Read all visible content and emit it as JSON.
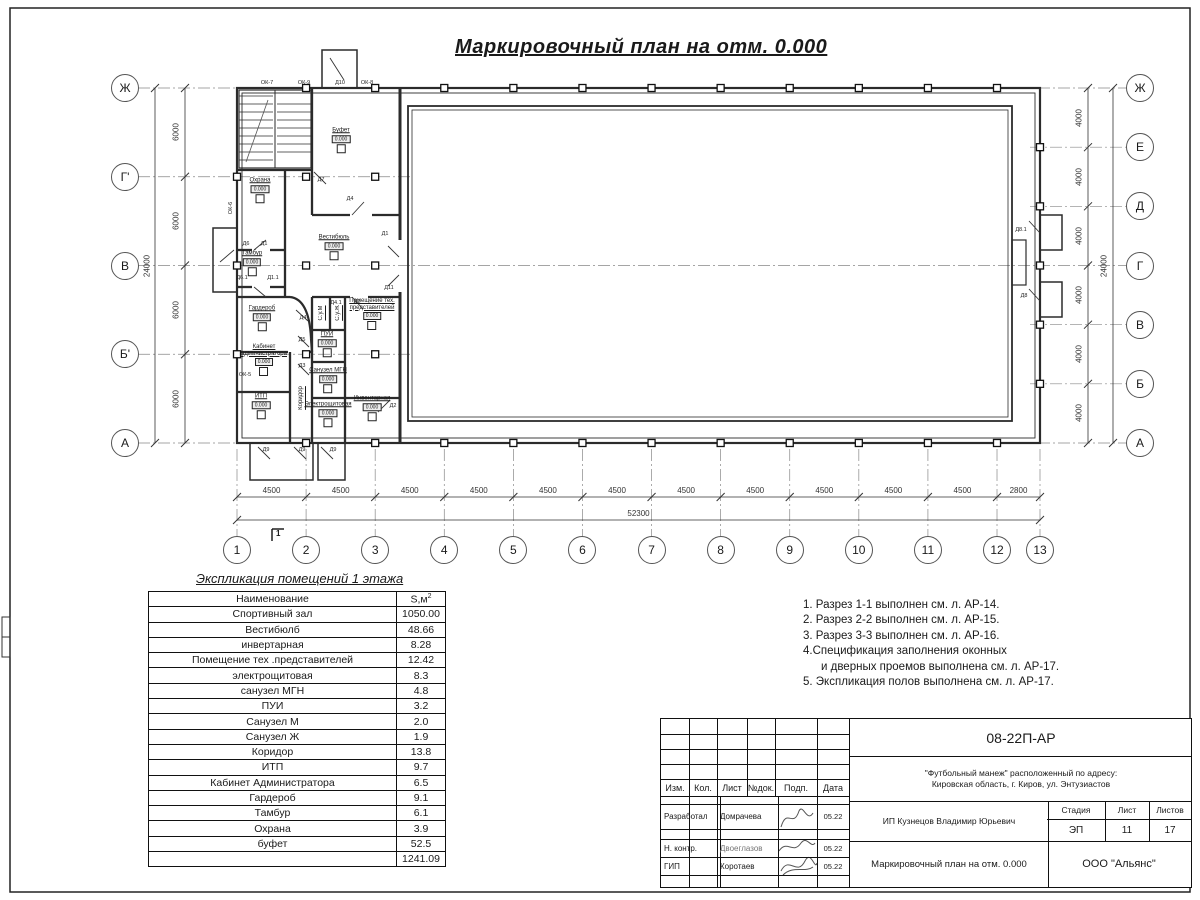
{
  "sheet": {
    "title": "Маркировочный план на отм. 0.000"
  },
  "plan": {
    "axes_left": [
      "Ж",
      "Г'",
      "В",
      "Б'",
      "А"
    ],
    "axes_right": [
      "Ж",
      "Е",
      "Д",
      "Г",
      "В",
      "Б",
      "А"
    ],
    "axes_bottom": [
      "1",
      "2",
      "3",
      "4",
      "5",
      "6",
      "7",
      "8",
      "9",
      "10",
      "11",
      "12",
      "13"
    ],
    "dims_left": [
      "6000",
      "6000",
      "6000",
      "6000"
    ],
    "dims_left_total": "24000",
    "dims_right": [
      "4000",
      "4000",
      "4000",
      "4000",
      "4000",
      "4000"
    ],
    "dims_right_total": "24000",
    "dims_bottom": [
      "4500",
      "4500",
      "4500",
      "4500",
      "4500",
      "4500",
      "4500",
      "4500",
      "4500",
      "4500",
      "4500",
      "2800"
    ],
    "dims_bottom_total": "52300",
    "level_mark": "0.000",
    "section_mark": "1",
    "rooms": [
      {
        "name": "Буфет",
        "x": 341,
        "y": 140,
        "level": true
      },
      {
        "name": "Охрана",
        "x": 260,
        "y": 190,
        "level": true
      },
      {
        "name": "Тамбур",
        "x": 252,
        "y": 263,
        "level": true
      },
      {
        "name": "Вестибюль",
        "x": 334,
        "y": 247,
        "level": true
      },
      {
        "name": "Гардероб",
        "x": 262,
        "y": 318,
        "level": true
      },
      {
        "name": "Кабинет\nадминистратора",
        "x": 264,
        "y": 360,
        "level": true
      },
      {
        "name": "ИТП",
        "x": 261,
        "y": 406,
        "level": true
      },
      {
        "name": "Коридор",
        "x": 301,
        "y": 398,
        "vertical": true
      },
      {
        "name": "Электрощитовая",
        "x": 328,
        "y": 414,
        "level": true
      },
      {
        "name": "Инвентарная",
        "x": 372,
        "y": 408,
        "level": true
      },
      {
        "name": "Помещение тех.\nпредставителей",
        "x": 372,
        "y": 314,
        "level": true
      },
      {
        "name": "ПУИ",
        "x": 327,
        "y": 344,
        "level": true
      },
      {
        "name": "Санузел МГН",
        "x": 328,
        "y": 380,
        "level": true
      },
      {
        "name": "С.у.М",
        "x": 321,
        "y": 313,
        "vertical": true
      },
      {
        "name": "С.у.Ж",
        "x": 338,
        "y": 313,
        "vertical": true
      }
    ],
    "openings": [
      {
        "label": "ОК-7",
        "x": 267,
        "y": 83
      },
      {
        "label": "ОК-9",
        "x": 304,
        "y": 83
      },
      {
        "label": "Д10",
        "x": 340,
        "y": 83
      },
      {
        "label": "ОК-8",
        "x": 367,
        "y": 83
      },
      {
        "label": "ОК-6",
        "x": 231,
        "y": 208,
        "vertical": true
      },
      {
        "label": "ОК-5",
        "x": 245,
        "y": 375
      },
      {
        "label": "Д7",
        "x": 321,
        "y": 180
      },
      {
        "label": "Д4",
        "x": 350,
        "y": 199
      },
      {
        "label": "Д6",
        "x": 246,
        "y": 244
      },
      {
        "label": "Д1",
        "x": 264,
        "y": 244
      },
      {
        "label": "Д6.1",
        "x": 242,
        "y": 278
      },
      {
        "label": "Д1.1",
        "x": 273,
        "y": 278
      },
      {
        "label": "Д1",
        "x": 385,
        "y": 234
      },
      {
        "label": "Д11",
        "x": 389,
        "y": 288
      },
      {
        "label": "Д2",
        "x": 357,
        "y": 302
      },
      {
        "label": "Д4.1",
        "x": 336,
        "y": 303
      },
      {
        "label": "Д4",
        "x": 303,
        "y": 318
      },
      {
        "label": "Д5",
        "x": 302,
        "y": 340
      },
      {
        "label": "Д3",
        "x": 302,
        "y": 366
      },
      {
        "label": "Д2",
        "x": 393,
        "y": 406
      },
      {
        "label": "Д9",
        "x": 266,
        "y": 450
      },
      {
        "label": "Д9",
        "x": 302,
        "y": 450
      },
      {
        "label": "Д9",
        "x": 333,
        "y": 450
      },
      {
        "label": "Д8.1",
        "x": 1021,
        "y": 230
      },
      {
        "label": "Д8",
        "x": 1024,
        "y": 296
      }
    ]
  },
  "schedule": {
    "title": "Экспликация помещений 1 этажа",
    "col_name": "Наименование",
    "col_area": "S,м",
    "col_area_sup": "2",
    "rows": [
      [
        "Спортивный зал",
        "1050.00"
      ],
      [
        "Вестибюлб",
        "48.66"
      ],
      [
        "инвертарная",
        "8.28"
      ],
      [
        "Помещение тех .представителей",
        "12.42"
      ],
      [
        "электрощитовая",
        "8.3"
      ],
      [
        "санузел МГН",
        "4.8"
      ],
      [
        "ПУИ",
        "3.2"
      ],
      [
        "Санузел М",
        "2.0"
      ],
      [
        "Санузел Ж",
        "1.9"
      ],
      [
        "Коридор",
        "13.8"
      ],
      [
        "ИТП",
        "9.7"
      ],
      [
        "Кабинет Администратора",
        "6.5"
      ],
      [
        "Гардероб",
        "9.1"
      ],
      [
        "Тамбур",
        "6.1"
      ],
      [
        "Охрана",
        "3.9"
      ],
      [
        "буфет",
        "52.5"
      ]
    ],
    "total": "1241.09"
  },
  "notes": [
    {
      "text": "1. Разрез 1-1 выполнен см. л. АР-14.",
      "indent": false
    },
    {
      "text": "2. Разрез 2-2 выполнен см. л. АР-15.",
      "indent": false
    },
    {
      "text": "3. Разрез 3-3 выполнен см. л. АР-16.",
      "indent": false
    },
    {
      "text": "4.Спецификация заполнения оконных",
      "indent": false
    },
    {
      "text": "и дверных проемов выполнена см. л. АР-17.",
      "indent": true
    },
    {
      "text": "5. Экспликация полов выполнена см. л. АР-17.",
      "indent": false
    }
  ],
  "stamp": {
    "doc_number": "08-22П-АР",
    "project_line1": "\"Футбольный манеж\" расположенный по адресу:",
    "project_line2": "Кировская область, г. Киров, ул. Энтузиастов",
    "client": "ИП Кузнецов Владимир Юрьевич",
    "sheet_title": "Маркировочный план на отм. 0.000",
    "org": "ООО \"Альянс\"",
    "stage_label": "Стадия",
    "sheet_label": "Лист",
    "sheets_label": "Листов",
    "stage": "ЭП",
    "sheet_no": "11",
    "sheets_total": "17",
    "cols": [
      "Изм.",
      "Кол.",
      "Лист",
      "№док.",
      "Подп.",
      "Дата"
    ],
    "roles": [
      {
        "role": "Разработал",
        "name": "Домрачева",
        "date": "05.22",
        "gray": false
      },
      {
        "role": "Н. контр.",
        "name": "Двоеглазов",
        "date": "05.22",
        "gray": true
      },
      {
        "role": "ГИП",
        "name": "Коротаев",
        "date": "05.22",
        "gray": false
      }
    ]
  }
}
